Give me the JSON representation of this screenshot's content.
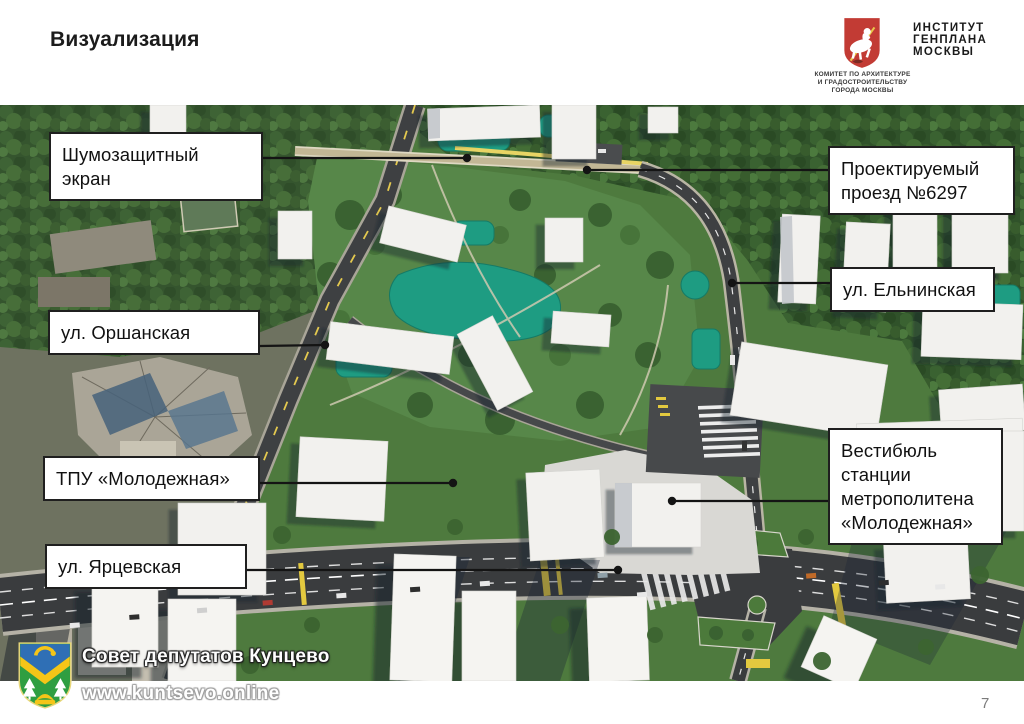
{
  "slide": {
    "title": "Визуализация",
    "page_number": "7"
  },
  "header": {
    "committee": {
      "lines": [
        "КОМИТЕТ ПО АРХИТЕКТУРЕ",
        "И ГРАДОСТРОИТЕЛЬСТВУ",
        "ГОРОДА МОСКВЫ"
      ]
    },
    "institute": {
      "lines": [
        "ИНСТИТУТ",
        "ГЕНПЛАНА",
        "МОСКВЫ"
      ]
    }
  },
  "map": {
    "callouts": [
      {
        "id": "noise-screen",
        "label": "Шумозащитный экран"
      },
      {
        "id": "projected-driveway",
        "label": "Проектируемый проезд №6297"
      },
      {
        "id": "elninskaya-street",
        "label": "ул. Ельнинская"
      },
      {
        "id": "orshanskaya-street",
        "label": "ул. Оршанская"
      },
      {
        "id": "tpu-molodezhnaya",
        "label": "ТПУ «Молодежная»"
      },
      {
        "id": "metro-vestibule",
        "label": "Вестибюль станции метрополитена «Молодежная»"
      },
      {
        "id": "yartsevskaya-street",
        "label": "ул. Ярцевская"
      }
    ]
  },
  "footer": {
    "council": "Совет депутатов Кунцево",
    "website": "www.kuntsevo.online"
  },
  "colors": {
    "callout_border": "#1f1f1f",
    "moscow_arms_red": "#c23b34",
    "kuntsevo_green": "#2f9e41",
    "kuntsevo_blue": "#2f6fb5",
    "kuntsevo_yellow": "#f5c518",
    "playground_teal": "#1e9c82",
    "road_asphalt": "#3a3c3e"
  }
}
